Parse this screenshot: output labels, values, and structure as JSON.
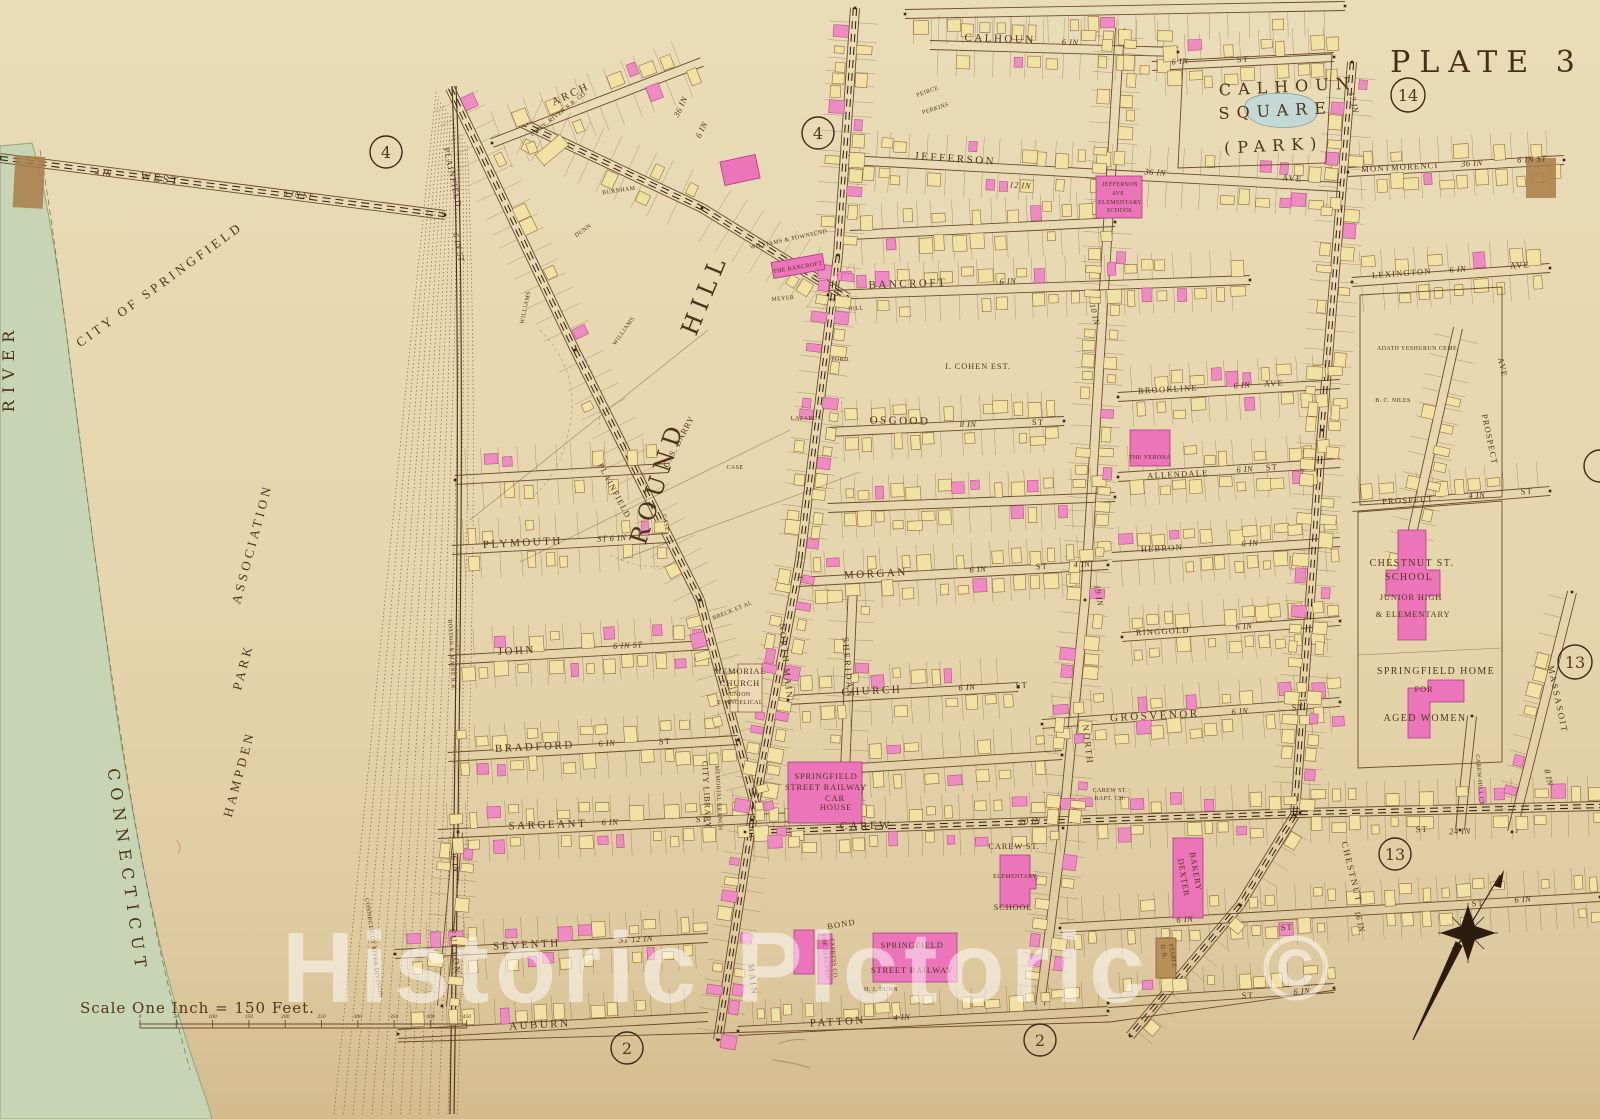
{
  "plate": {
    "title": "PLATE 3"
  },
  "watermark": {
    "text": "Historic Pictoric",
    "symbol": "©"
  },
  "scale": {
    "label": "Scale One Inch = 150 Feet.",
    "ticks": [
      "0",
      "50",
      "100",
      "150",
      "200",
      "250",
      "300",
      "350",
      "400",
      "450"
    ]
  },
  "circled": {
    "west": "4",
    "main_top": "4",
    "montmorenci": "14",
    "massasoit": "13",
    "carew": "13",
    "auburn": "2",
    "patton": "2"
  },
  "areas": {
    "calhoun_square": {
      "line1": "CALHOUN",
      "line2": "SQUARE",
      "line3": "(PARK)"
    },
    "city_of_springfield": "CITY OF SPRINGFIELD",
    "river": "RIVER",
    "connecticut": "CONNECTICUT",
    "hampden": {
      "word1": "HAMPDEN",
      "word2": "PARK",
      "word3": "ASSOCIATION"
    },
    "round_hill": {
      "word1": "ROUND",
      "word2": "HILL"
    }
  },
  "streets": {
    "calhoun": {
      "name": "CALHOUN",
      "gauge": "6 IN"
    },
    "park_st": {
      "gauge": "6 IN",
      "type": "ST"
    },
    "jefferson": {
      "name": "JEFFERSON",
      "gauge": "36 IN",
      "gauge2": "12 IN",
      "type": "AVE"
    },
    "montmorenci": {
      "name": "MONTMORENCI",
      "gauge": "36 IN",
      "type": "6 IN ST"
    },
    "west": {
      "name": "WEST",
      "gauge": "4 IN",
      "type": "6 IN ST"
    },
    "arch": {
      "name": "ARCH",
      "gauge": "36 IN",
      "gauge2": "6 IN"
    },
    "plainfield": {
      "name": "PLAINFIELD",
      "type": "6 IN ST",
      "name2": "PLAINFIELD"
    },
    "lexington": {
      "name": "LEXINGTON",
      "gauge": "6 IN",
      "type": "AVE"
    },
    "bancroft": {
      "name": "BANCROFT",
      "gauge": "6 IN"
    },
    "brookline": {
      "name": "BROOKLINE",
      "gauge": "6 IN",
      "type": "AVE"
    },
    "osgood": {
      "name": "OSGOOD",
      "gauge": "8 IN",
      "type": "ST"
    },
    "allendale": {
      "name": "ALLENDALE",
      "gauge": "6 IN",
      "type": "ST"
    },
    "prospect_st": {
      "name": "PROSPECT",
      "gauge": "4 IN",
      "type": "ST"
    },
    "prospect_ave": {
      "name": "PROSPECT",
      "type": "AVE"
    },
    "plymouth": {
      "name": "PLYMOUTH",
      "type": "ST 6 IN"
    },
    "hebron": {
      "name": "HEBRON",
      "gauge": "6 IN"
    },
    "morgan": {
      "name": "MORGAN",
      "gauge": "6 IN",
      "type": "ST",
      "gauge2": "4 IN"
    },
    "ringgold": {
      "name": "RINGGOLD",
      "gauge": "6 IN"
    },
    "john": {
      "name": "JOHN",
      "type": "6 IN ST"
    },
    "church": {
      "name": "CHURCH",
      "gauge": "6 IN",
      "type": "ST"
    },
    "grosvenor": {
      "name": "GROSVENOR",
      "gauge": "6 IN",
      "type": "ST"
    },
    "bradford": {
      "name": "BRADFORD",
      "gauge": "6 IN",
      "type": "ST"
    },
    "sargeant": {
      "name": "SARGEANT",
      "gauge": "6 IN",
      "type": "ST"
    },
    "carew": {
      "name": "CAREW",
      "gauge": "20 IN",
      "type": "ST",
      "gauge2": "24 IN"
    },
    "seventh": {
      "name": "SEVENTH",
      "type": "ST 12 IN"
    },
    "sixth_se": {
      "gauge": "6 IN",
      "type": "ST",
      "type2": "ST",
      "gauge2": "6 IN"
    },
    "auburn": {
      "name": "AUBURN"
    },
    "patton": {
      "name": "PATTON",
      "gauge": "4 IN"
    },
    "bond": {
      "name": "BOND"
    },
    "fulton": {
      "name": "FULTON",
      "gauge": "36 IN"
    },
    "main": {
      "name": "MAIN"
    },
    "north_main": {
      "name": "NORTH MAIN"
    },
    "north": {
      "name": "NORTH"
    },
    "sheridan": {
      "name": "SHERIDAN"
    },
    "chestnut": {
      "name": "CHESTNUT",
      "gauge": "16 IN"
    },
    "massasoit": {
      "name": "MASSASOIT",
      "gauge": "8 IN"
    },
    "carew_hill_ct": {
      "name": "CAREW-HILL CT"
    },
    "st_se2": {
      "type": "ST",
      "gauge": "6 IN"
    },
    "tenth": {
      "gauge": "10 IN"
    },
    "nineteenth": {
      "gauge": "19 IN"
    },
    "twelfth": {
      "gauge": "12 IN"
    },
    "boston_maine": {
      "name": "BOSTON & MAINE R.R."
    },
    "conn_river_div": {
      "name": "CONNECTICUT RIVER DIVISION"
    },
    "conn_river_rr": {
      "name": "CONN. RIVER R.R. CO."
    }
  },
  "landmarks": {
    "memorial_church": {
      "line1": "MEMORIAL",
      "line2": "CHURCH",
      "line3": "UNION",
      "line4": "EVANGELICAL"
    },
    "city_library": {
      "line1": "CITY LIBRARY",
      "line2": "MEMORIAL BRANCH"
    },
    "car_house": {
      "line1": "SPRINGFIELD",
      "line2": "STREET RAILWAY",
      "line3": "CAR",
      "line4": "HOUSE"
    },
    "street_railway2": {
      "line1": "SPRINGFIELD",
      "line2": "STREET RAILWAY"
    },
    "electric_express": {
      "line1": "THE ELECTRIC",
      "line2": "EXPRESS CO."
    },
    "hj_dunn": "H. J. DUNN",
    "carew_school": {
      "line1": "CAREW ST.",
      "line2": "ELEMENTARY",
      "line3": "SCHOOL"
    },
    "dexter": {
      "line1": "DEXTER",
      "line2": "BAKERY"
    },
    "db_stable": {
      "line1": "D. B.",
      "line2": "STABLE"
    },
    "jefferson_school": {
      "line1": "JEFFERSON",
      "line2": "AVE",
      "line3": "ELEMENTARY",
      "line4": "SCHOOL"
    },
    "chestnut_school": {
      "line1": "CHESTNUT ST.",
      "line2": "SCHOOL",
      "line3": "JUNIOR HIGH",
      "line4": "& ELEMENTARY"
    },
    "home_aged_women": {
      "line1": "SPRINGFIELD HOME",
      "line2": "FOR",
      "line3": "AGED WOMEN"
    },
    "carew_bapt": {
      "line1": "CAREW ST.",
      "line2": "BAPT. CH."
    },
    "cohen": "I. COHEN EST.",
    "adath": "ADATH YESHURUN CEME",
    "niles": "B. C. NILES",
    "verona": "THE VERONA",
    "barry": "G. S. BARRY",
    "williams": "WILLIAMS",
    "williams2": "WILLIAMS",
    "breck": "BRECK ET AL",
    "burnham": "BURNHAM",
    "dunn2": "DUNN",
    "meyer": "MEYER",
    "hill_small": "HILL",
    "ford": "FORD",
    "the_bancroft": "THE BANCROFT",
    "williams_townsend": "WILLIAMS & TOWNSEND",
    "lazarus": "LAZARUS",
    "perkins": "PERKINS",
    "peirce": "PEIRCE",
    "case1": "CASE",
    "case2": "CASE"
  },
  "colors": {
    "ink": "#50361c",
    "building_yellow": "#f1e1a3",
    "building_pink": "#ee8bc3",
    "river_green": "#c8d5b4",
    "pond_blue": "#c4d8d5",
    "paper": "#e9dcb8",
    "paper_dark": "#d3bb8c",
    "watermark": "#ffffff"
  }
}
